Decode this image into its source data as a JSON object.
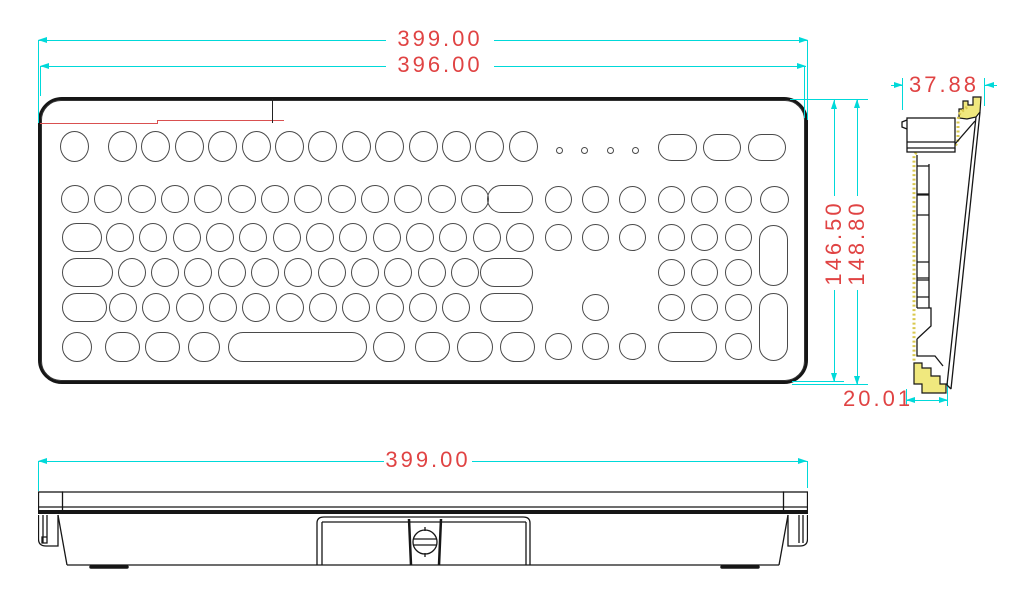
{
  "title": "Keyboard dimensional drawing (top, side and front views)",
  "colors": {
    "dimension_line": "#00d9d9",
    "dimension_text": "#e04343",
    "outline": "#161616",
    "key_outline": "#4a4a4a",
    "gasket_yellow": "#f0e87e",
    "gasket_edge": "#d9c84e",
    "section_red_line": "#d95050",
    "background": "#ffffff"
  },
  "dims": {
    "top_outer_width": "399.00",
    "top_inner_width": "396.00",
    "height_inner": "146.50",
    "height_outer": "148.80",
    "side_top_depth": "37.88",
    "side_bottom_depth": "20.01",
    "front_width": "399.00"
  },
  "keyboard": {
    "keys": [
      [
        22,
        34,
        29,
        31,
        "e"
      ],
      [
        70,
        34,
        29,
        31,
        "e"
      ],
      [
        103,
        34,
        29,
        31,
        "e"
      ],
      [
        137,
        34,
        29,
        31,
        "e"
      ],
      [
        170,
        34,
        29,
        31,
        "e"
      ],
      [
        204,
        34,
        29,
        31,
        "e"
      ],
      [
        237,
        34,
        29,
        31,
        "e"
      ],
      [
        270,
        34,
        29,
        31,
        "e"
      ],
      [
        304,
        34,
        29,
        31,
        "e"
      ],
      [
        337,
        34,
        29,
        31,
        "e"
      ],
      [
        371,
        34,
        29,
        31,
        "e"
      ],
      [
        404,
        34,
        29,
        31,
        "e"
      ],
      [
        437,
        34,
        29,
        31,
        "e"
      ],
      [
        471,
        34,
        29,
        31,
        "e"
      ],
      [
        620,
        37,
        39,
        27,
        "s"
      ],
      [
        665,
        37,
        38,
        27,
        "s"
      ],
      [
        710,
        37,
        38,
        27,
        "s"
      ],
      [
        23,
        88,
        28,
        28,
        "e"
      ],
      [
        56,
        88,
        28,
        28,
        "e"
      ],
      [
        90,
        88,
        28,
        28,
        "e"
      ],
      [
        123,
        88,
        28,
        28,
        "e"
      ],
      [
        156,
        88,
        28,
        28,
        "e"
      ],
      [
        190,
        88,
        28,
        28,
        "e"
      ],
      [
        223,
        88,
        28,
        28,
        "e"
      ],
      [
        256,
        88,
        28,
        28,
        "e"
      ],
      [
        290,
        88,
        28,
        28,
        "e"
      ],
      [
        323,
        88,
        28,
        28,
        "e"
      ],
      [
        356,
        88,
        28,
        28,
        "e"
      ],
      [
        390,
        88,
        28,
        28,
        "e"
      ],
      [
        423,
        88,
        28,
        28,
        "e"
      ],
      [
        449,
        88,
        46,
        28,
        "s"
      ],
      [
        507,
        89,
        27,
        27,
        "e"
      ],
      [
        544,
        89,
        27,
        27,
        "e"
      ],
      [
        581,
        89,
        27,
        27,
        "e"
      ],
      [
        620,
        89,
        27,
        27,
        "e"
      ],
      [
        653,
        89,
        27,
        27,
        "e"
      ],
      [
        687,
        89,
        27,
        27,
        "e"
      ],
      [
        722,
        89,
        29,
        27,
        "e"
      ],
      [
        24,
        126,
        40,
        29,
        "s"
      ],
      [
        68,
        126,
        28,
        29,
        "e"
      ],
      [
        101,
        126,
        28,
        29,
        "e"
      ],
      [
        135,
        126,
        28,
        29,
        "e"
      ],
      [
        168,
        126,
        28,
        29,
        "e"
      ],
      [
        201,
        126,
        28,
        29,
        "e"
      ],
      [
        235,
        126,
        28,
        29,
        "e"
      ],
      [
        268,
        126,
        28,
        29,
        "e"
      ],
      [
        301,
        126,
        28,
        29,
        "e"
      ],
      [
        335,
        126,
        28,
        29,
        "e"
      ],
      [
        368,
        126,
        28,
        29,
        "e"
      ],
      [
        401,
        126,
        28,
        29,
        "e"
      ],
      [
        435,
        126,
        28,
        29,
        "e"
      ],
      [
        468,
        126,
        28,
        29,
        "e"
      ],
      [
        507,
        127,
        27,
        27,
        "e"
      ],
      [
        544,
        127,
        27,
        27,
        "e"
      ],
      [
        581,
        127,
        27,
        27,
        "e"
      ],
      [
        620,
        127,
        27,
        27,
        "e"
      ],
      [
        653,
        127,
        27,
        27,
        "e"
      ],
      [
        687,
        127,
        27,
        27,
        "e"
      ],
      [
        721,
        128,
        29,
        61,
        "s"
      ],
      [
        24,
        161,
        51,
        29,
        "s"
      ],
      [
        80,
        161,
        28,
        29,
        "e"
      ],
      [
        113,
        161,
        28,
        29,
        "e"
      ],
      [
        146,
        161,
        28,
        29,
        "e"
      ],
      [
        180,
        161,
        28,
        29,
        "e"
      ],
      [
        213,
        161,
        28,
        29,
        "e"
      ],
      [
        246,
        161,
        28,
        29,
        "e"
      ],
      [
        280,
        161,
        28,
        29,
        "e"
      ],
      [
        313,
        161,
        28,
        29,
        "e"
      ],
      [
        346,
        161,
        28,
        29,
        "e"
      ],
      [
        380,
        161,
        28,
        29,
        "e"
      ],
      [
        413,
        161,
        28,
        29,
        "e"
      ],
      [
        442,
        161,
        53,
        29,
        "s"
      ],
      [
        620,
        162,
        27,
        27,
        "e"
      ],
      [
        653,
        162,
        27,
        27,
        "e"
      ],
      [
        687,
        162,
        27,
        27,
        "e"
      ],
      [
        24,
        196,
        45,
        29,
        "s"
      ],
      [
        71,
        196,
        28,
        29,
        "e"
      ],
      [
        104,
        196,
        28,
        29,
        "e"
      ],
      [
        138,
        196,
        28,
        29,
        "e"
      ],
      [
        171,
        196,
        28,
        29,
        "e"
      ],
      [
        204,
        196,
        28,
        29,
        "e"
      ],
      [
        238,
        196,
        28,
        29,
        "e"
      ],
      [
        271,
        196,
        28,
        29,
        "e"
      ],
      [
        304,
        196,
        28,
        29,
        "e"
      ],
      [
        338,
        196,
        28,
        29,
        "e"
      ],
      [
        371,
        196,
        28,
        29,
        "e"
      ],
      [
        404,
        196,
        28,
        29,
        "e"
      ],
      [
        442,
        196,
        53,
        29,
        "s"
      ],
      [
        544,
        197,
        27,
        27,
        "e"
      ],
      [
        620,
        197,
        27,
        27,
        "e"
      ],
      [
        653,
        197,
        27,
        27,
        "e"
      ],
      [
        687,
        197,
        27,
        27,
        "e"
      ],
      [
        721,
        196,
        29,
        68,
        "s"
      ],
      [
        24,
        235,
        30,
        30,
        "s"
      ],
      [
        67,
        235,
        35,
        30,
        "s"
      ],
      [
        107,
        235,
        35,
        30,
        "s"
      ],
      [
        150,
        235,
        32,
        30,
        "s"
      ],
      [
        190,
        235,
        139,
        30,
        "s"
      ],
      [
        335,
        235,
        32,
        30,
        "s"
      ],
      [
        377,
        235,
        35,
        30,
        "s"
      ],
      [
        419,
        235,
        36,
        30,
        "s"
      ],
      [
        462,
        235,
        35,
        30,
        "s"
      ],
      [
        507,
        236,
        27,
        27,
        "e"
      ],
      [
        544,
        236,
        27,
        27,
        "e"
      ],
      [
        581,
        236,
        27,
        27,
        "e"
      ],
      [
        620,
        235,
        59,
        30,
        "s"
      ],
      [
        687,
        236,
        27,
        27,
        "e"
      ]
    ],
    "leds": [
      [
        518,
        50
      ],
      [
        543,
        50
      ],
      [
        569,
        50
      ],
      [
        594,
        50
      ]
    ]
  }
}
